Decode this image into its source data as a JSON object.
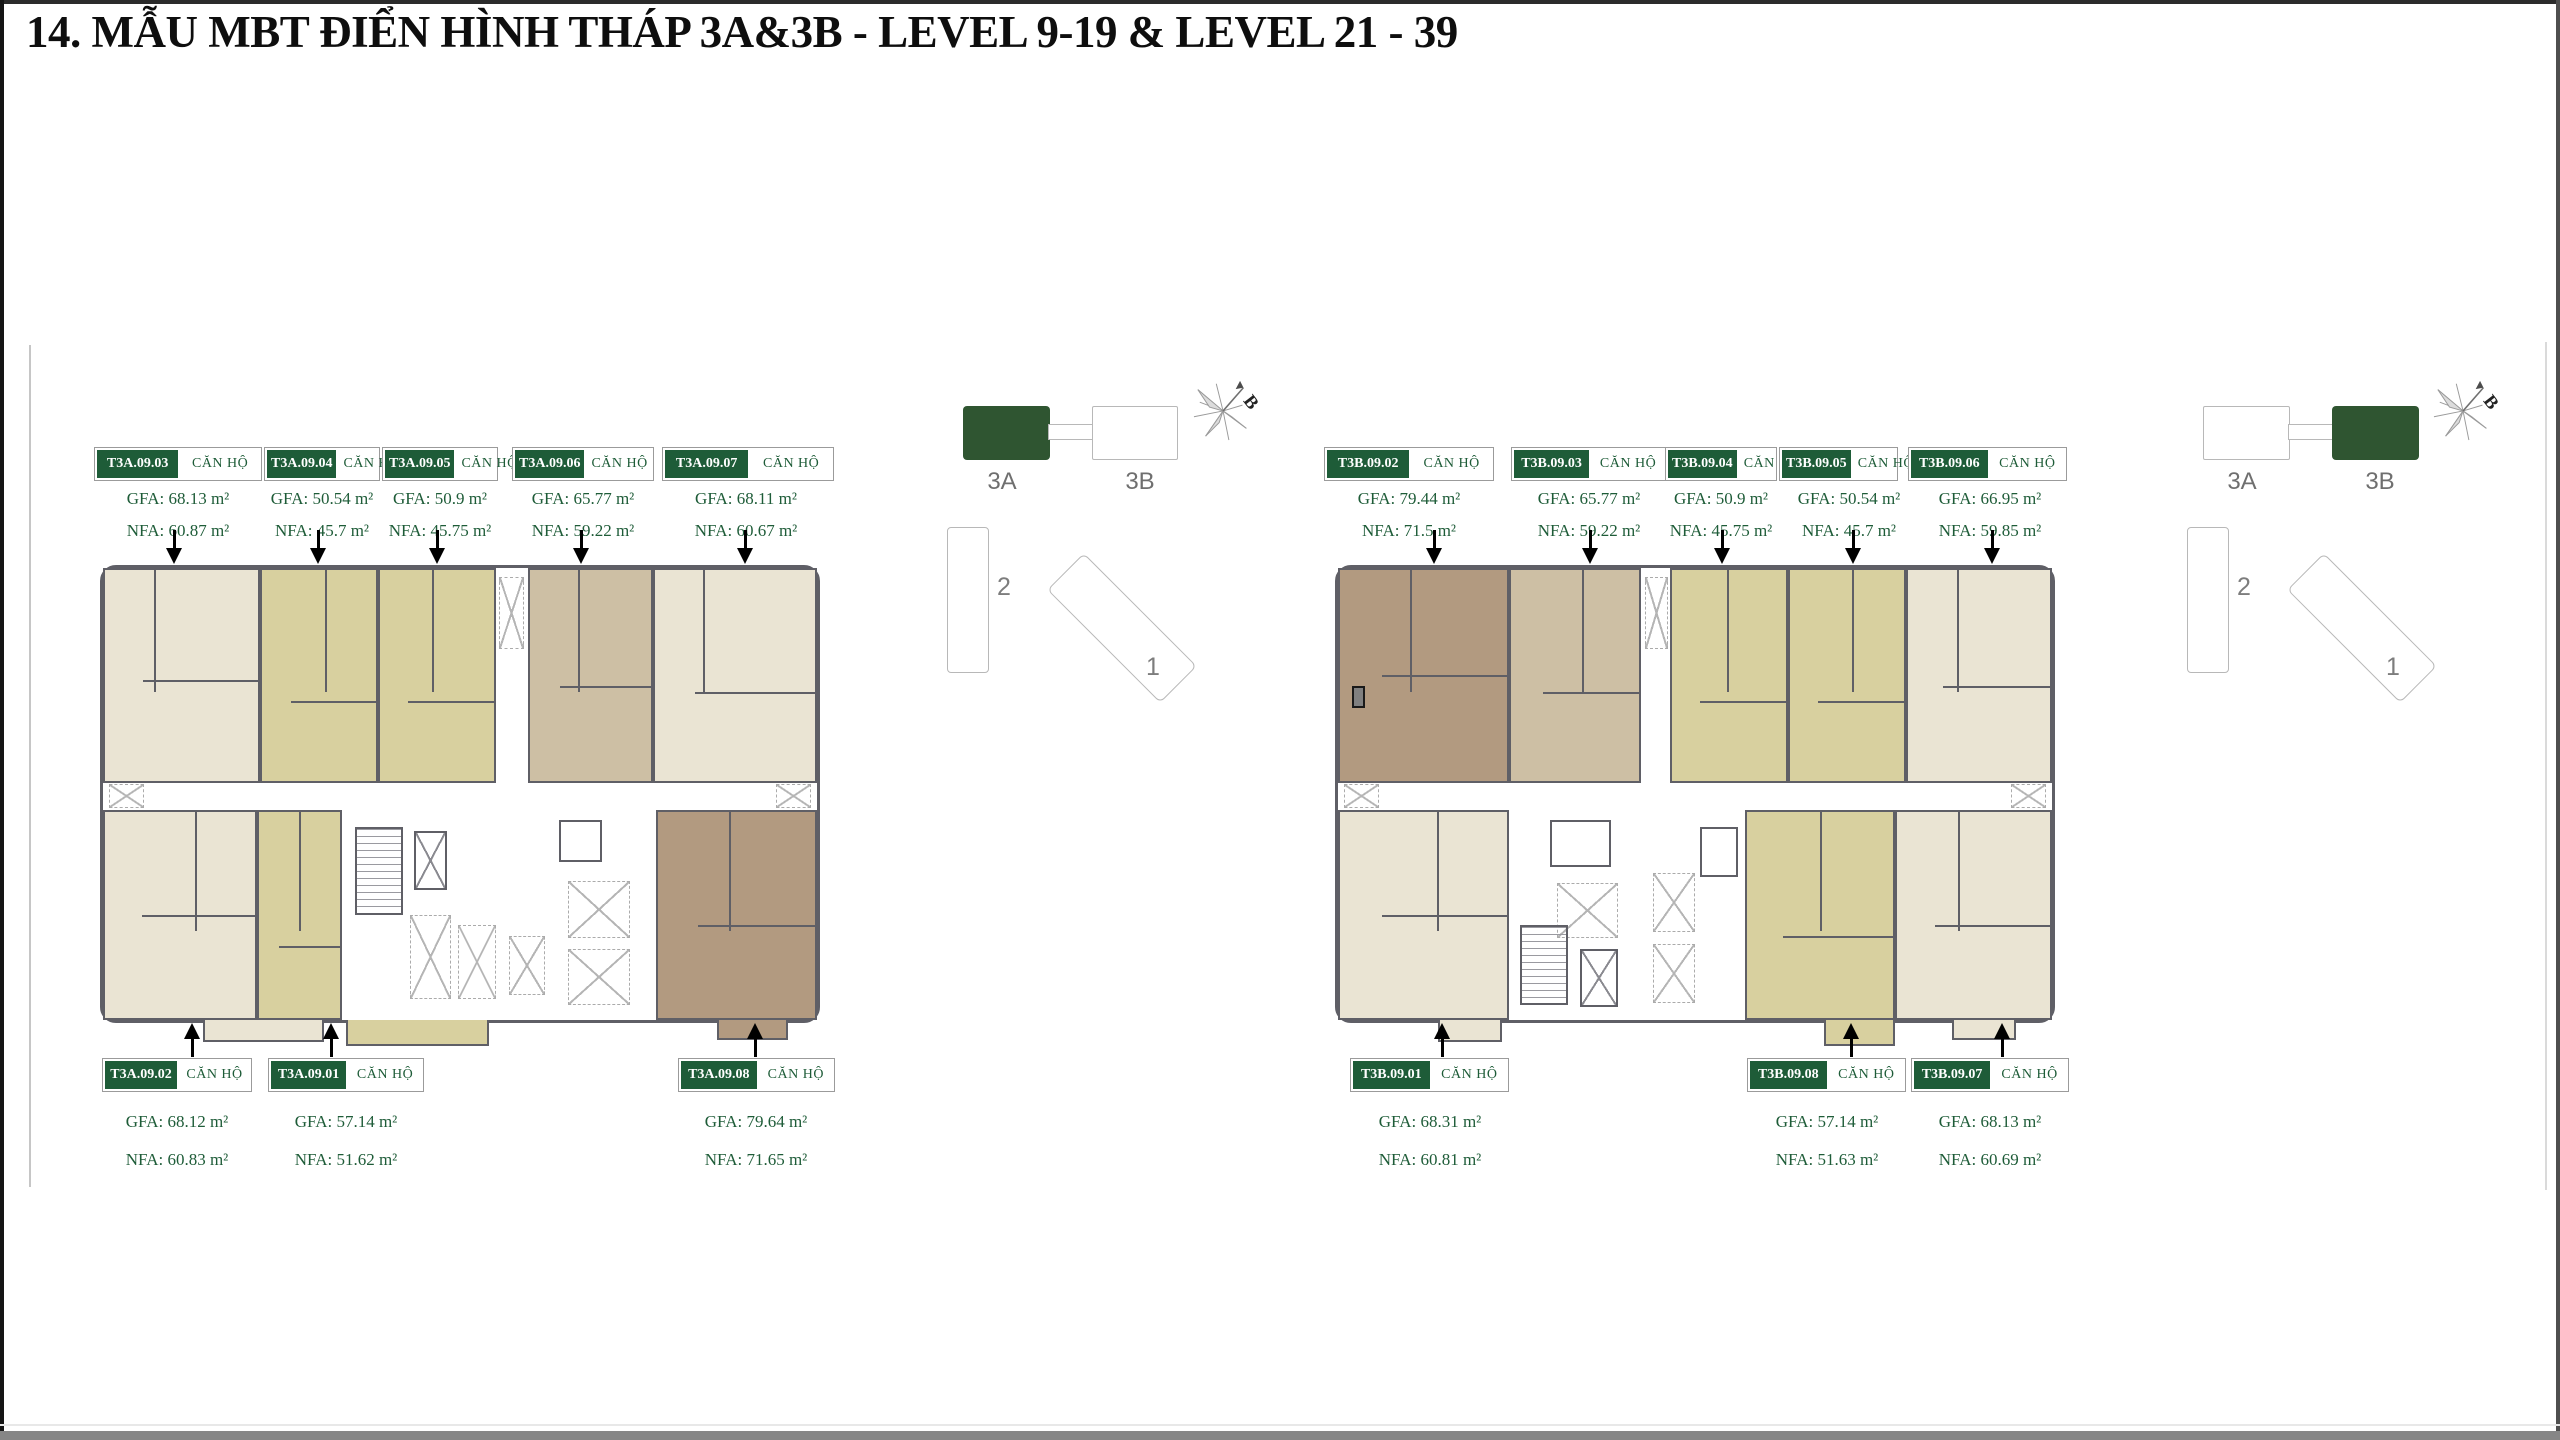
{
  "title": "14. MẪU MBT ĐIỂN HÌNH THÁP 3A&3B - LEVEL 9-19 & LEVEL 21 - 39",
  "unit_type_label": "CĂN HỘ",
  "compass_label": "B",
  "keyplan": {
    "tower_a_label": "3A",
    "tower_b_label": "3B",
    "building_1_label": "1",
    "building_2_label": "2"
  },
  "colors": {
    "accent_green": "#1e5c38",
    "keyplan_green": "#2f5531",
    "wall_gray": "#5f5f66",
    "unit_cream": "#eae4d3",
    "unit_khaki": "#d8d09f",
    "unit_tan": "#cdbfa4",
    "unit_brown": "#b29a80"
  },
  "plan_3a": {
    "top_units": [
      {
        "code": "T3A.09.03",
        "gfa": "GFA: 68.13 m²",
        "nfa": "NFA: 60.87 m²"
      },
      {
        "code": "T3A.09.04",
        "gfa": "GFA: 50.54 m²",
        "nfa": "NFA: 45.7 m²"
      },
      {
        "code": "T3A.09.05",
        "gfa": "GFA: 50.9 m²",
        "nfa": "NFA: 45.75 m²"
      },
      {
        "code": "T3A.09.06",
        "gfa": "GFA: 65.77 m²",
        "nfa": "NFA: 59.22 m²"
      },
      {
        "code": "T3A.09.07",
        "gfa": "GFA: 68.11 m²",
        "nfa": "NFA: 60.67 m²"
      }
    ],
    "bottom_units": [
      {
        "code": "T3A.09.02",
        "gfa": "GFA: 68.12 m²",
        "nfa": "NFA: 60.83 m²"
      },
      {
        "code": "T3A.09.01",
        "gfa": "GFA: 57.14 m²",
        "nfa": "NFA: 51.62 m²"
      },
      {
        "code": "T3A.09.08",
        "gfa": "GFA: 79.64 m²",
        "nfa": "NFA: 71.65 m²"
      }
    ]
  },
  "plan_3b": {
    "top_units": [
      {
        "code": "T3B.09.02",
        "gfa": "GFA: 79.44 m²",
        "nfa": "NFA: 71.5 m²"
      },
      {
        "code": "T3B.09.03",
        "gfa": "GFA: 65.77 m²",
        "nfa": "NFA: 59.22 m²"
      },
      {
        "code": "T3B.09.04",
        "gfa": "GFA: 50.9 m²",
        "nfa": "NFA: 45.75 m²"
      },
      {
        "code": "T3B.09.05",
        "gfa": "GFA: 50.54 m²",
        "nfa": "NFA: 45.7 m²"
      },
      {
        "code": "T3B.09.06",
        "gfa": "GFA: 66.95 m²",
        "nfa": "NFA: 59.85 m²"
      }
    ],
    "bottom_units": [
      {
        "code": "T3B.09.01",
        "gfa": "GFA: 68.31 m²",
        "nfa": "NFA: 60.81 m²"
      },
      {
        "code": "T3B.09.08",
        "gfa": "GFA: 57.14 m²",
        "nfa": "NFA: 51.63 m²"
      },
      {
        "code": "T3B.09.07",
        "gfa": "GFA: 68.13 m²",
        "nfa": "NFA: 60.69 m²"
      }
    ]
  }
}
